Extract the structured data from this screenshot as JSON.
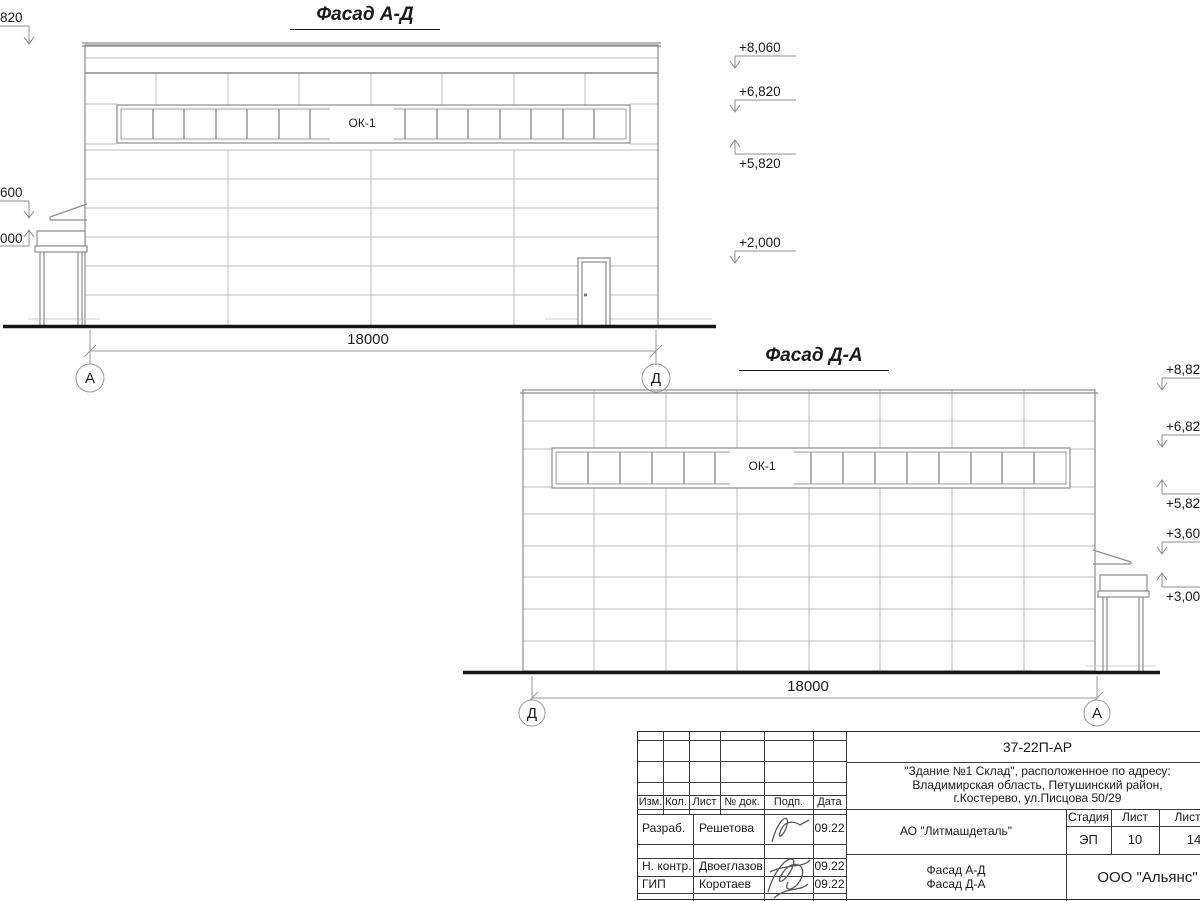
{
  "drawing": {
    "facade_ad": {
      "title": "Фасад А-Д",
      "window_label": "ОК-1",
      "dimension": "18000",
      "axes": {
        "left": "А",
        "right": "Д"
      },
      "elevation_marks_right": [
        {
          "label": "+8,060"
        },
        {
          "label": "+6,820"
        },
        {
          "label": "+5,820"
        },
        {
          "label": "+2,000"
        }
      ],
      "elevation_marks_left": [
        {
          "label": "820"
        },
        {
          "label": "600"
        },
        {
          "label": "000"
        }
      ]
    },
    "facade_da": {
      "title": "Фасад Д-А",
      "window_label": "ОК-1",
      "dimension": "18000",
      "axes": {
        "left": "Д",
        "right": "А"
      },
      "elevation_marks_right": [
        {
          "label": "+8,82"
        },
        {
          "label": "+6,82"
        },
        {
          "label": "+5,82"
        },
        {
          "label": "+3,60"
        },
        {
          "label": "+3,00"
        }
      ]
    }
  },
  "titleblock": {
    "doc_number": "37-22П-АР",
    "project": {
      "line1": "\"Здание №1 Склад\", расположенное по адресу:",
      "line2": "Владимирская область, Петушинский район,",
      "line3": "г.Костерево, ул.Писцова 50/29"
    },
    "columns": [
      "Изм.",
      "Кол.",
      "Лист",
      "№ док.",
      "Подп.",
      "Дата"
    ],
    "signature_rows": [
      {
        "role": "Разраб.",
        "name": "Решетова",
        "date": "09.22"
      },
      {
        "role": "Н. контр.",
        "name": "Двоеглазов",
        "date": "09.22"
      },
      {
        "role": "ГИП",
        "name": "Коротаев",
        "date": "09.22"
      }
    ],
    "client": "АО \"Литмашдеталь\"",
    "stage": {
      "headers": [
        "Стадия",
        "Лист",
        "Листов"
      ],
      "values": [
        "ЭП",
        "10",
        "14"
      ]
    },
    "sheet_name": {
      "line1": "Фасад А-Д",
      "line2": "Фасад Д-А"
    },
    "organization": "ООО \"Альянс\""
  }
}
